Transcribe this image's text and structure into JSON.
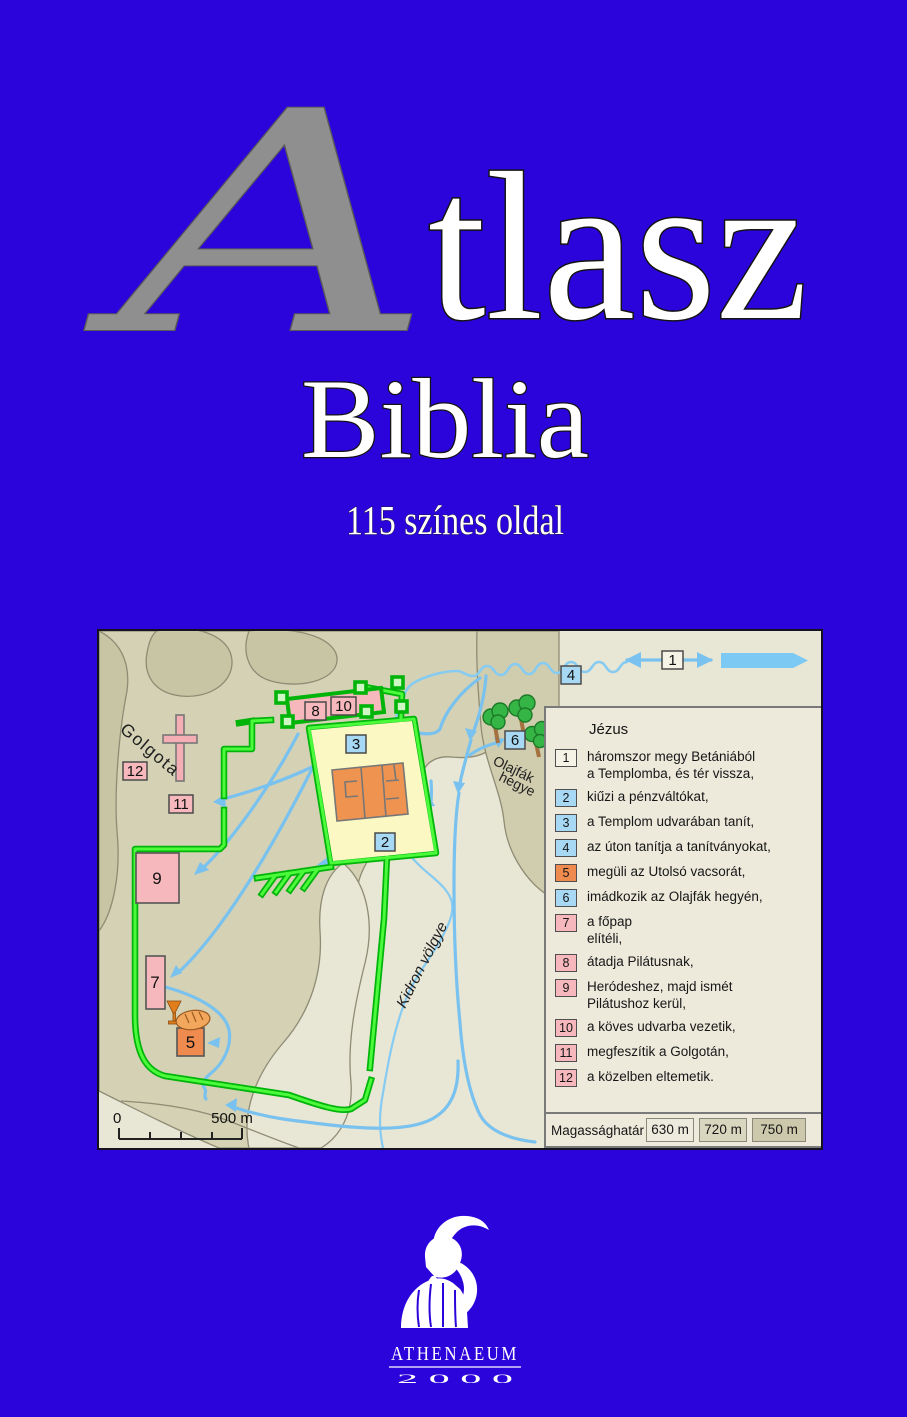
{
  "cover": {
    "background_color": "#2B04DB",
    "title_initial": "A",
    "title_rest": "tlasz",
    "subtitle": "Biblia",
    "tagline": "115 színes oldal"
  },
  "map": {
    "place_labels": {
      "golgota": "Golgota",
      "olajfak_line1": "Olajfák",
      "olajfak_line2": "hegye",
      "kidron": "Kidron völgye"
    },
    "scale": {
      "start": "0",
      "end": "500 m"
    },
    "markers": [
      {
        "label": "1",
        "fill": "#F5F3E6"
      },
      {
        "label": "2",
        "fill": "#A8D9F4"
      },
      {
        "label": "3",
        "fill": "#A8D9F4"
      },
      {
        "label": "4",
        "fill": "#A8D9F4"
      },
      {
        "label": "5",
        "fill": "#EF8B4E"
      },
      {
        "label": "6",
        "fill": "#A8D9F4"
      },
      {
        "label": "7",
        "fill": "#F6B8BC"
      },
      {
        "label": "8",
        "fill": "#F6B8BC"
      },
      {
        "label": "9",
        "fill": "#F6B8BC"
      },
      {
        "label": "10",
        "fill": "#F6B8BC"
      },
      {
        "label": "11",
        "fill": "#F6B8BC"
      },
      {
        "label": "12",
        "fill": "#F6B8BC"
      }
    ],
    "legend": {
      "title": "Jézus",
      "items": [
        {
          "num": "1",
          "fill": "#F5F3E6",
          "text": "háromszor megy Betániából\na Templomba, és tér vissza,"
        },
        {
          "num": "2",
          "fill": "#A8D9F4",
          "text": "kiűzi a pénzváltókat,"
        },
        {
          "num": "3",
          "fill": "#A8D9F4",
          "text": "a Templom udvarában tanít,"
        },
        {
          "num": "4",
          "fill": "#A8D9F4",
          "text": "az úton tanítja a tanítványokat,"
        },
        {
          "num": "5",
          "fill": "#EF8B4E",
          "text": "megüli az Utolsó vacsorát,"
        },
        {
          "num": "6",
          "fill": "#A8D9F4",
          "text": "imádkozik az Olajfák hegyén,"
        },
        {
          "num": "7",
          "fill": "#F6B8BC",
          "text": "a főpap\nelítéli,"
        },
        {
          "num": "8",
          "fill": "#F6B8BC",
          "text": "átadja Pilátusnak,"
        },
        {
          "num": "9",
          "fill": "#F6B8BC",
          "text": "Heródeshez, majd ismét\nPilátushoz kerül,"
        },
        {
          "num": "10",
          "fill": "#F6B8BC",
          "text": "a köves udvarba vezetik,"
        },
        {
          "num": "11",
          "fill": "#F6B8BC",
          "text": "megfeszítik a Golgotán,"
        },
        {
          "num": "12",
          "fill": "#F6B8BC",
          "text": "a közelben eltemetik."
        }
      ],
      "altitude": {
        "label": "Magassághatár",
        "levels": [
          {
            "value": "630 m",
            "fill": "#EDEBDE"
          },
          {
            "value": "720 m",
            "fill": "#D9D6BF"
          },
          {
            "value": "750 m",
            "fill": "#CBC8AB"
          }
        ]
      }
    }
  },
  "publisher": {
    "name": "ATHENAEUM",
    "year": "2 0 0 0"
  }
}
